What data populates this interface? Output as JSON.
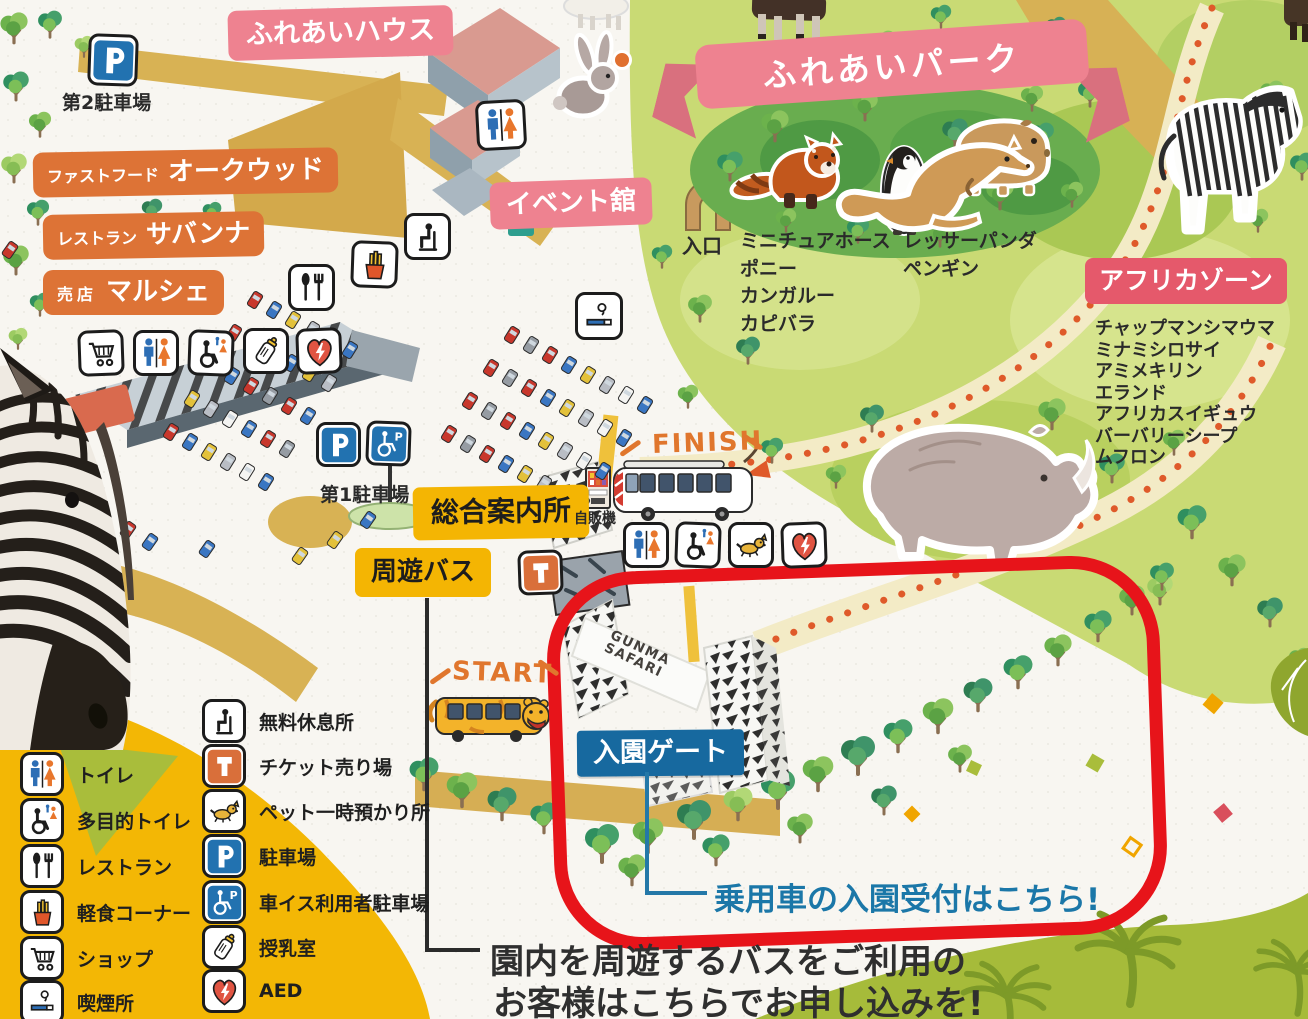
{
  "region_labels": {
    "fureai_house": "ふれあいハウス",
    "fureai_park": "ふれあいパーク",
    "event_hall": "イベント舘",
    "africa_zone": "アフリカゾーン"
  },
  "facilities": {
    "parking2": "第2駐車場",
    "parking1": "第1駐車場",
    "fastfood_type": "ファストフード",
    "fastfood_name": "オークウッド",
    "restaurant_type": "レストラン",
    "restaurant_name": "サバンナ",
    "shop_type": "売店",
    "shop_name": "マルシェ",
    "info_center": "総合案内所",
    "tour_bus": "周遊バス",
    "vending_machine": "自販機",
    "entrance": "入口",
    "entry_gate": "入園ゲート"
  },
  "route_markers": {
    "start": "START",
    "finish": "FINISH"
  },
  "gate_text": {
    "line1": "GUNMA",
    "line2": "SAFARI"
  },
  "callouts": {
    "car_reception": "乗用車の入園受付はこちら!",
    "bus_note_line1": "園内を周遊するバスをご利用の",
    "bus_note_line2": "お客様はこちらでお申し込みを!"
  },
  "fureai_park_animals": {
    "col1": [
      "ミニチュアホース",
      "ポニー",
      "カンガルー",
      "カピバラ"
    ],
    "col2": [
      "レッサーパンダ",
      "ペンギン"
    ]
  },
  "africa_zone_animals": [
    "チャップマンシマウマ",
    "ミナミシロサイ",
    "アミメキリン",
    "エランド",
    "アフリカスイギュウ",
    "バーバリーシープ",
    "ムフロン"
  ],
  "legend": {
    "col1": [
      {
        "icon": "toilet-icon",
        "label": "トイレ"
      },
      {
        "icon": "accessible-toilet-icon",
        "label": "多目的トイレ"
      },
      {
        "icon": "restaurant-icon",
        "label": "レストラン"
      },
      {
        "icon": "snack-icon",
        "label": "軽食コーナー"
      },
      {
        "icon": "shop-icon",
        "label": "ショップ"
      },
      {
        "icon": "smoking-icon",
        "label": "喫煙所"
      }
    ],
    "col2": [
      {
        "icon": "rest-area-icon",
        "label": "無料休息所"
      },
      {
        "icon": "ticket-icon",
        "label": "チケット売り場"
      },
      {
        "icon": "pet-icon",
        "label": "ペット一時預かり所"
      },
      {
        "icon": "parking-icon",
        "label": "駐車場"
      },
      {
        "icon": "accessible-parking-icon",
        "label": "車イス利用者駐車場"
      },
      {
        "icon": "nursing-icon",
        "label": "授乳室"
      },
      {
        "icon": "aed-icon",
        "label": "AED"
      }
    ]
  },
  "colors": {
    "banner_pink": "#ee8290",
    "zone_red": "#e5596b",
    "facility_orange": "#dd7336",
    "facility_yellow": "#f4b503",
    "gate_blue": "#17699f",
    "callout_blue": "#1b77a8",
    "highlight_red": "#e7141a"
  }
}
